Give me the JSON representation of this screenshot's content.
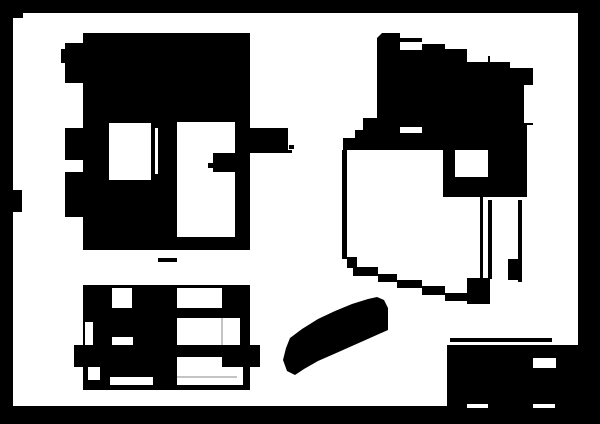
{
  "canvas": {
    "width": 600,
    "height": 424,
    "border_color": "#000000"
  },
  "colors": {
    "ink": "#000000",
    "paper": "#ffffff",
    "faint": "#c4c4c4"
  },
  "sheet": {
    "x": 13,
    "y": 13,
    "w": 565,
    "h": 393
  },
  "shapes": [
    {
      "name": "paper-sheet",
      "fill": "paper",
      "type": "rect",
      "x": 13,
      "y": 13,
      "w": 565,
      "h": 393
    },
    {
      "name": "border-step-top-left",
      "fill": "ink",
      "type": "rect",
      "x": 13,
      "y": 13,
      "w": 10,
      "h": 5
    },
    {
      "name": "border-notch-left",
      "fill": "ink",
      "type": "rect",
      "x": 13,
      "y": 190,
      "w": 9,
      "h": 22
    },
    {
      "name": "front-view-body",
      "fill": "ink",
      "type": "rect",
      "x": 83,
      "y": 33,
      "w": 167,
      "h": 217
    },
    {
      "name": "front-view-tab-upper",
      "fill": "ink",
      "type": "rect",
      "x": 65,
      "y": 43,
      "w": 18,
      "h": 40
    },
    {
      "name": "front-view-tab-upper-nub",
      "fill": "ink",
      "type": "rect",
      "x": 61,
      "y": 49,
      "w": 4,
      "h": 14
    },
    {
      "name": "front-view-tab-middle",
      "fill": "ink",
      "type": "rect",
      "x": 65,
      "y": 128,
      "w": 18,
      "h": 32
    },
    {
      "name": "front-view-tab-lower",
      "fill": "ink",
      "type": "rect",
      "x": 65,
      "y": 172,
      "w": 18,
      "h": 45
    },
    {
      "name": "front-view-boss-right",
      "fill": "ink",
      "type": "rect",
      "x": 250,
      "y": 128,
      "w": 38,
      "h": 24
    },
    {
      "name": "front-view-boss-line",
      "fill": "ink",
      "type": "rect",
      "x": 250,
      "y": 150,
      "w": 42,
      "h": 3
    },
    {
      "name": "front-view-boss-dot",
      "fill": "ink",
      "type": "rect",
      "x": 289,
      "y": 145,
      "w": 5,
      "h": 4
    },
    {
      "name": "front-view-window-left",
      "fill": "paper",
      "type": "rect",
      "x": 109,
      "y": 123,
      "w": 42,
      "h": 57
    },
    {
      "name": "front-view-window-sliver",
      "fill": "paper",
      "type": "rect",
      "x": 155,
      "y": 128,
      "w": 3,
      "h": 46
    },
    {
      "name": "front-view-opening-right",
      "fill": "paper",
      "type": "rect",
      "x": 177,
      "y": 122,
      "w": 58,
      "h": 115
    },
    {
      "name": "front-view-inner-block",
      "fill": "ink",
      "type": "rect",
      "x": 213,
      "y": 153,
      "w": 22,
      "h": 19
    },
    {
      "name": "front-view-inner-tick",
      "fill": "ink",
      "type": "rect",
      "x": 208,
      "y": 163,
      "w": 5,
      "h": 5
    },
    {
      "name": "centerline-dash",
      "fill": "ink",
      "type": "rect",
      "x": 158,
      "y": 258,
      "w": 19,
      "h": 4
    },
    {
      "name": "bottom-view-body",
      "fill": "ink",
      "type": "rect",
      "x": 83,
      "y": 285,
      "w": 167,
      "h": 105
    },
    {
      "name": "bottom-view-window-top-left",
      "fill": "paper",
      "type": "rect",
      "x": 112,
      "y": 288,
      "w": 20,
      "h": 20
    },
    {
      "name": "bottom-view-window-top-right",
      "fill": "paper",
      "type": "rect",
      "x": 177,
      "y": 288,
      "w": 45,
      "h": 20
    },
    {
      "name": "bottom-view-slot-left",
      "fill": "paper",
      "type": "rect",
      "x": 85,
      "y": 322,
      "w": 8,
      "h": 23
    },
    {
      "name": "bottom-view-window-mid-left",
      "fill": "paper",
      "type": "rect",
      "x": 112,
      "y": 337,
      "w": 21,
      "h": 8
    },
    {
      "name": "bottom-view-opening-right",
      "fill": "paper",
      "type": "rect",
      "x": 177,
      "y": 318,
      "w": 63,
      "h": 27
    },
    {
      "name": "bottom-view-notch-bottom-left",
      "fill": "paper",
      "type": "rect",
      "x": 88,
      "y": 367,
      "w": 12,
      "h": 13
    },
    {
      "name": "bottom-view-notch-bottom",
      "fill": "paper",
      "type": "rect",
      "x": 110,
      "y": 377,
      "w": 43,
      "h": 8
    },
    {
      "name": "bottom-view-opening-bottom-right",
      "fill": "paper",
      "type": "rect",
      "x": 177,
      "y": 367,
      "w": 66,
      "h": 18
    },
    {
      "name": "bottom-view-flange-bar",
      "fill": "ink",
      "type": "rect",
      "x": 74,
      "y": 345,
      "w": 186,
      "h": 22
    },
    {
      "name": "bottom-view-bar-gap",
      "fill": "paper",
      "type": "rect",
      "x": 177,
      "y": 357,
      "w": 45,
      "h": 10
    },
    {
      "name": "bottom-view-faint-line-vertical",
      "fill": "faint",
      "type": "rect",
      "x": 221,
      "y": 318,
      "w": 2,
      "h": 27
    },
    {
      "name": "bottom-view-faint-line-horizontal",
      "fill": "faint",
      "type": "rect",
      "x": 177,
      "y": 376,
      "w": 60,
      "h": 2
    },
    {
      "name": "iso-view-top-slab",
      "fill": "ink",
      "type": "polygon",
      "points": "382,33 400,33 400,38 422,38 422,44 445,44 445,49 467,49 467,56 490,56 490,62 510,62 510,68 533,68 533,125 527,125 527,197 443,197 443,150 343,150 343,138 355,138 355,130 363,130 363,118 377,118 377,38"
    },
    {
      "name": "iso-view-notch-a",
      "fill": "paper",
      "type": "rect",
      "x": 400,
      "y": 42,
      "w": 22,
      "h": 8
    },
    {
      "name": "iso-view-notch-b",
      "fill": "paper",
      "type": "rect",
      "x": 467,
      "y": 52,
      "w": 21,
      "h": 10
    },
    {
      "name": "iso-view-dash",
      "fill": "paper",
      "type": "rect",
      "x": 400,
      "y": 127,
      "w": 22,
      "h": 6
    },
    {
      "name": "iso-view-sliver-right",
      "fill": "paper",
      "type": "rect",
      "x": 524,
      "y": 85,
      "w": 9,
      "h": 38
    },
    {
      "name": "iso-view-window",
      "fill": "paper",
      "type": "rect",
      "x": 455,
      "y": 150,
      "w": 33,
      "h": 27
    },
    {
      "name": "iso-view-edge-left",
      "fill": "ink",
      "type": "rect",
      "x": 342,
      "y": 150,
      "w": 5,
      "h": 109
    },
    {
      "name": "iso-view-bottom-step-1",
      "fill": "ink",
      "type": "rect",
      "x": 347,
      "y": 257,
      "w": 10,
      "h": 11
    },
    {
      "name": "iso-view-bottom-step-2",
      "fill": "ink",
      "type": "rect",
      "x": 353,
      "y": 267,
      "w": 25,
      "h": 9
    },
    {
      "name": "iso-view-bottom-step-3",
      "fill": "ink",
      "type": "rect",
      "x": 378,
      "y": 274,
      "w": 19,
      "h": 8
    },
    {
      "name": "iso-view-bottom-step-4",
      "fill": "ink",
      "type": "rect",
      "x": 397,
      "y": 280,
      "w": 25,
      "h": 8
    },
    {
      "name": "iso-view-bottom-step-5",
      "fill": "ink",
      "type": "rect",
      "x": 422,
      "y": 286,
      "w": 23,
      "h": 9
    },
    {
      "name": "iso-view-bottom-step-6",
      "fill": "ink",
      "type": "rect",
      "x": 445,
      "y": 293,
      "w": 22,
      "h": 8
    },
    {
      "name": "iso-view-corner-blob",
      "fill": "ink",
      "type": "rect",
      "x": 467,
      "y": 278,
      "w": 23,
      "h": 26
    },
    {
      "name": "iso-view-line-inner-1",
      "fill": "ink",
      "type": "rect",
      "x": 480,
      "y": 197,
      "w": 3,
      "h": 82
    },
    {
      "name": "iso-view-line-inner-2",
      "fill": "ink",
      "type": "rect",
      "x": 488,
      "y": 200,
      "w": 4,
      "h": 79
    },
    {
      "name": "iso-view-line-right",
      "fill": "ink",
      "type": "rect",
      "x": 518,
      "y": 200,
      "w": 4,
      "h": 82
    },
    {
      "name": "iso-view-block-right",
      "fill": "ink",
      "type": "rect",
      "x": 508,
      "y": 259,
      "w": 12,
      "h": 21
    },
    {
      "name": "pointer-mark",
      "fill": "ink",
      "type": "polygon",
      "points": "286,348 290,338 302,329 318,319 335,311 352,304 368,299 377,297 384,300 388,308 388,330 370,338 352,346 334,354 318,361 304,369 295,375 287,371 283,360"
    },
    {
      "name": "title-block-top-line",
      "fill": "ink",
      "type": "rect",
      "x": 450,
      "y": 338,
      "w": 102,
      "h": 4
    },
    {
      "name": "title-block-body",
      "fill": "ink",
      "type": "rect",
      "x": 447,
      "y": 345,
      "w": 131,
      "h": 61
    },
    {
      "name": "title-block-field-window",
      "fill": "paper",
      "type": "rect",
      "x": 533,
      "y": 358,
      "w": 23,
      "h": 10
    },
    {
      "name": "title-block-dash-left",
      "fill": "paper",
      "type": "rect",
      "x": 467,
      "y": 404,
      "w": 21,
      "h": 4
    },
    {
      "name": "title-block-dash-right",
      "fill": "paper",
      "type": "rect",
      "x": 533,
      "y": 404,
      "w": 22,
      "h": 4
    }
  ]
}
